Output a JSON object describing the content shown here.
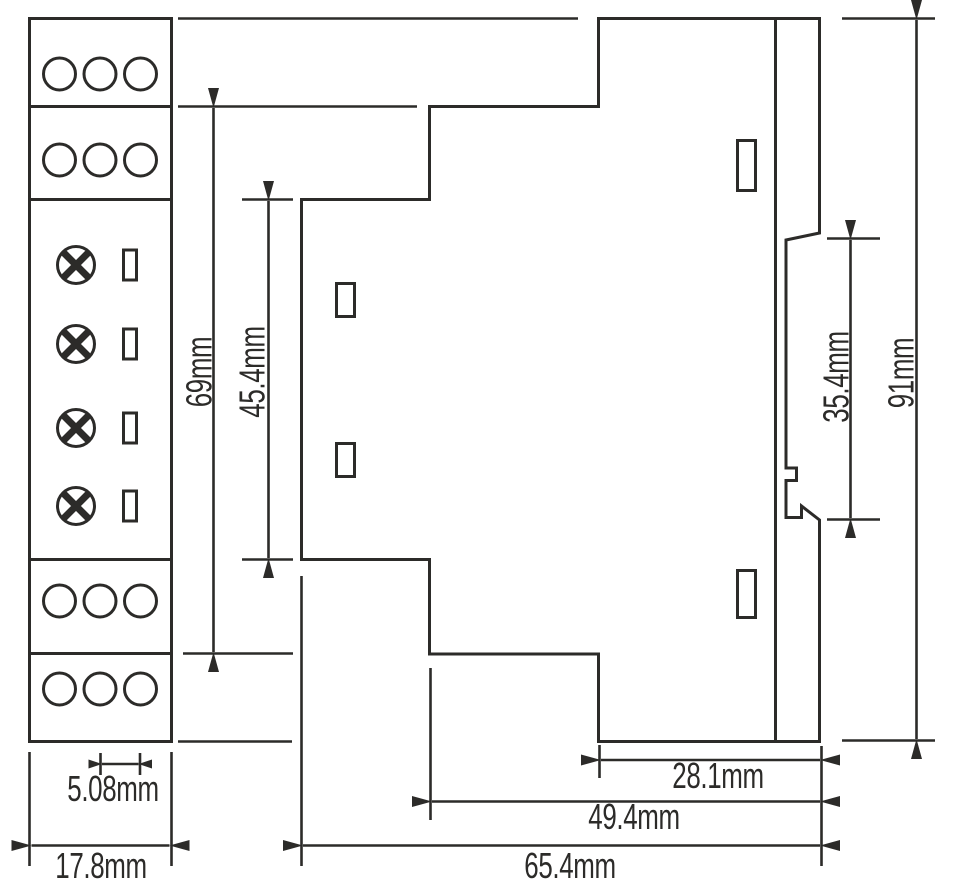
{
  "diagram": {
    "description": "DIN-rail module dimensional drawing, front view and side view",
    "colors": {
      "line": "#2c2b29",
      "background": "#ffffff"
    },
    "dimensions": {
      "front_body_height": "69mm",
      "front_recess_height": "45.4mm",
      "rail_recess_height": "35.4mm",
      "overall_height": "91mm",
      "terminal_pitch": "5.08mm",
      "module_width": "17.8mm",
      "rear_depth": "28.1mm",
      "lower_depth": "49.4mm",
      "overall_depth": "65.4mm"
    }
  }
}
